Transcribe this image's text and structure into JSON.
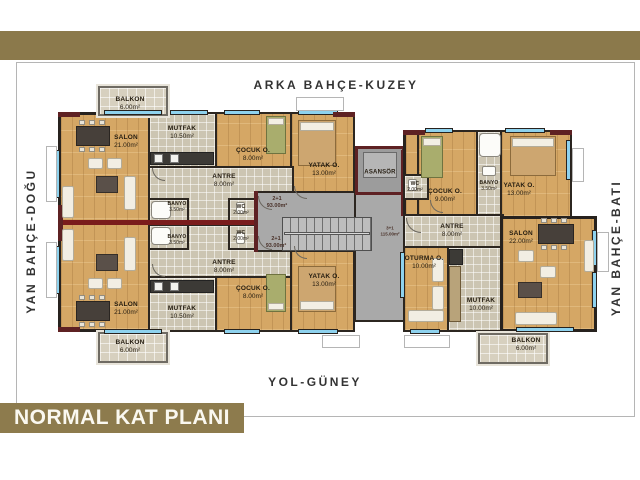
{
  "title_banner": "NORMAL KAT PLANI",
  "compass": {
    "north": "ARKA BAHÇE-KUZEY",
    "south": "YOL-GÜNEY",
    "east": "YAN BAHÇE-DOĞU",
    "west": "YAN BAHÇE-BATI"
  },
  "core": {
    "elevator": "ASANSÖR"
  },
  "units": {
    "top_left": {
      "type": "2+1",
      "area": "93.00m²",
      "rooms": [
        {
          "name": "BALKON",
          "area": "6.00m²"
        },
        {
          "name": "SALON",
          "area": "21.00m²"
        },
        {
          "name": "MUTFAK",
          "area": "10.50m²"
        },
        {
          "name": "ÇOCUK O.",
          "area": "8.00m²"
        },
        {
          "name": "YATAK O.",
          "area": "13.00m²"
        },
        {
          "name": "ANTRE",
          "area": "8.00m²"
        },
        {
          "name": "BANYO",
          "area": "3.50m²"
        },
        {
          "name": "WC",
          "area": "2.00m²"
        }
      ]
    },
    "bottom_left": {
      "type": "2+1",
      "area": "93.00m²",
      "rooms": [
        {
          "name": "BALKON",
          "area": "6.00m²"
        },
        {
          "name": "SALON",
          "area": "21.00m²"
        },
        {
          "name": "MUTFAK",
          "area": "10.50m²"
        },
        {
          "name": "ÇOCUK O.",
          "area": "8.00m²"
        },
        {
          "name": "YATAK O.",
          "area": "13.00m²"
        },
        {
          "name": "ANTRE",
          "area": "8.00m²"
        },
        {
          "name": "BANYO",
          "area": "3.50m²"
        },
        {
          "name": "WC",
          "area": "2.00m²"
        }
      ]
    },
    "right": {
      "type": "3+1",
      "area": "115.00m²",
      "rooms": [
        {
          "name": "WC",
          "area": "2.00m²"
        },
        {
          "name": "ÇOCUK O.",
          "area": "9.00m²"
        },
        {
          "name": "BANYO",
          "area": "3.50m²"
        },
        {
          "name": "YATAK O.",
          "area": "13.00m²"
        },
        {
          "name": "ANTRE",
          "area": "8.00m²"
        },
        {
          "name": "SALON",
          "area": "22.00m²"
        },
        {
          "name": "OTURMA O.",
          "area": "10.00m²"
        },
        {
          "name": "MUTFAK",
          "area": "10.00m²"
        },
        {
          "name": "BALKON",
          "area": "6.00m²"
        }
      ]
    }
  },
  "colors": {
    "band_brown": "#8b794b",
    "banner_brown": "#8d7b4d",
    "wall_dark": "#27221e",
    "wall_maroon": "#5e2123",
    "divider_red": "#7a1c1c",
    "window_blue": "#8ed2ee",
    "floor_wood": "#d5a765",
    "floor_tile": "#ccc5b2",
    "corridor_gray": "#a9a9a9"
  }
}
